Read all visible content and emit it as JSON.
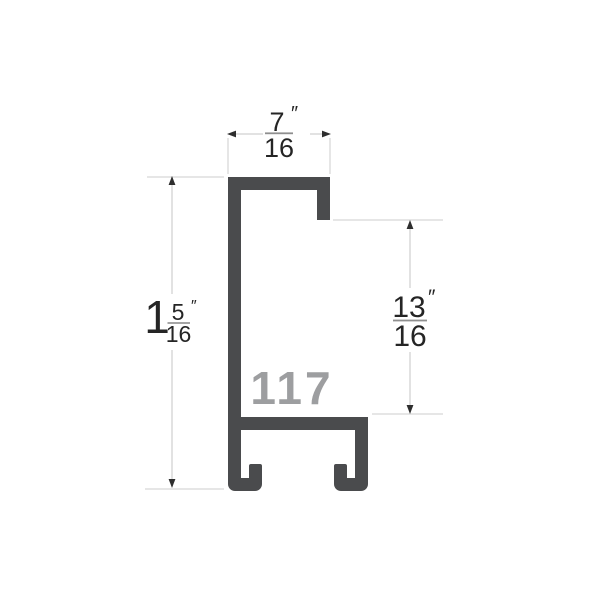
{
  "profile": {
    "number": "117",
    "shape_color": "#4a4b4d",
    "number_color": "#9d9ea0"
  },
  "dimensions": {
    "top_width": {
      "numerator": "7",
      "denominator": "16",
      "unit": "″"
    },
    "left_height": {
      "whole": "1",
      "numerator": "5",
      "denominator": "16",
      "unit": "″"
    },
    "right_depth": {
      "numerator": "13",
      "denominator": "16",
      "unit": "″"
    }
  },
  "colors": {
    "background": "#ffffff",
    "dimension_line": "#c4c4c4",
    "arrowhead": "#2e2e2e",
    "text": "#252525",
    "fraction_bar": "#8f8f8f"
  }
}
